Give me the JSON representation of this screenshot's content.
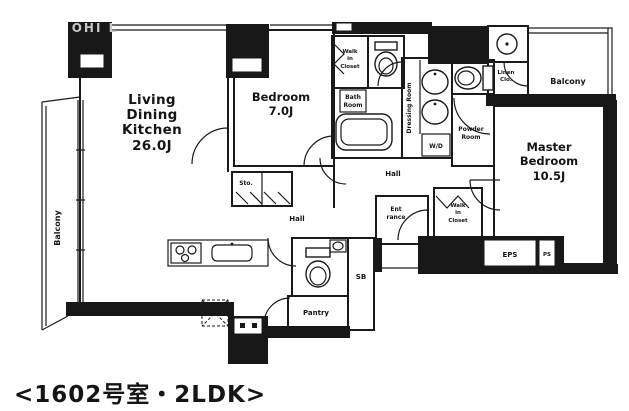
{
  "watermark": "OHI L",
  "caption": "<1602号室・2LDK>",
  "rooms": {
    "ldk": {
      "lines": [
        "Living",
        "Dining",
        "Kitchen",
        "26.0J"
      ]
    },
    "bedroom": {
      "lines": [
        "Bedroom",
        "7.0J"
      ]
    },
    "master_bedroom": {
      "lines": [
        "Master",
        "Bedroom",
        "10.5J"
      ]
    },
    "balcony_left": {
      "label": "Balcony"
    },
    "balcony_right": {
      "label": "Balcony"
    },
    "walk_in_closet_top": {
      "lines": [
        "Walk",
        "in",
        "Closet"
      ]
    },
    "walk_in_closet_right": {
      "lines": [
        "Walk",
        "in",
        "Closet"
      ]
    },
    "bath_room": {
      "lines": [
        "Bath",
        "Room"
      ]
    },
    "dressing_room": {
      "label": "Dressing Room"
    },
    "powder_room": {
      "lines": [
        "Powder",
        "Room"
      ]
    },
    "linen_closet": {
      "lines": [
        "Linen",
        "Clo."
      ]
    },
    "hall_upper": {
      "label": "Hall"
    },
    "hall_lower": {
      "label": "Hall"
    },
    "entrance": {
      "lines": [
        "Ent",
        "rance"
      ]
    },
    "pantry": {
      "label": "Pantry"
    },
    "storage": {
      "label": "Sto."
    },
    "shoe_box": {
      "label": "SB"
    },
    "washer_dryer": {
      "label": "W/D"
    },
    "eps": {
      "label": "EPS"
    },
    "ps": {
      "label": "PS"
    }
  }
}
